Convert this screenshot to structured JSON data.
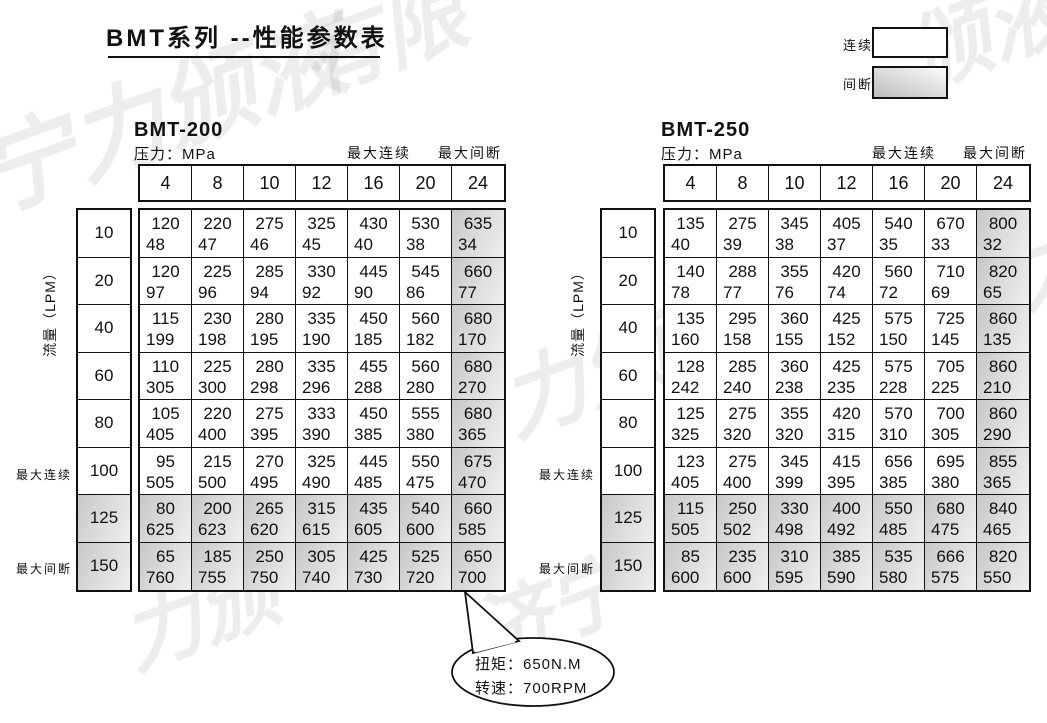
{
  "page": {
    "title": "BMT系列 --性能参数表",
    "watermark_text": "济宁力颁液压有限公司"
  },
  "legend": {
    "continuous": "连续",
    "intermittent": "间断"
  },
  "labels": {
    "pressure": "压力：MPa",
    "max_continuous": "最大连续",
    "max_intermittent": "最大间断",
    "flow_axis": "流量（LPM）"
  },
  "pressures_mpa": [
    "4",
    "8",
    "10",
    "12",
    "16",
    "20",
    "24"
  ],
  "flows_lpm": [
    "10",
    "20",
    "40",
    "60",
    "80",
    "100",
    "125",
    "150"
  ],
  "tables": [
    {
      "name": "BMT-200",
      "rows": [
        [
          [
            "120",
            "48"
          ],
          [
            "220",
            "47"
          ],
          [
            "275",
            "46"
          ],
          [
            "325",
            "45"
          ],
          [
            "430",
            "40"
          ],
          [
            "530",
            "38"
          ],
          [
            "635",
            "34"
          ]
        ],
        [
          [
            "120",
            "97"
          ],
          [
            "225",
            "96"
          ],
          [
            "285",
            "94"
          ],
          [
            "330",
            "92"
          ],
          [
            "445",
            "90"
          ],
          [
            "545",
            "86"
          ],
          [
            "660",
            "77"
          ]
        ],
        [
          [
            "115",
            "199"
          ],
          [
            "230",
            "198"
          ],
          [
            "280",
            "195"
          ],
          [
            "335",
            "190"
          ],
          [
            "450",
            "185"
          ],
          [
            "560",
            "182"
          ],
          [
            "680",
            "170"
          ]
        ],
        [
          [
            "110",
            "305"
          ],
          [
            "225",
            "300"
          ],
          [
            "280",
            "298"
          ],
          [
            "335",
            "296"
          ],
          [
            "455",
            "288"
          ],
          [
            "560",
            "280"
          ],
          [
            "680",
            "270"
          ]
        ],
        [
          [
            "105",
            "405"
          ],
          [
            "220",
            "400"
          ],
          [
            "275",
            "395"
          ],
          [
            "333",
            "390"
          ],
          [
            "450",
            "385"
          ],
          [
            "555",
            "380"
          ],
          [
            "680",
            "365"
          ]
        ],
        [
          [
            "95",
            "505"
          ],
          [
            "215",
            "500"
          ],
          [
            "270",
            "495"
          ],
          [
            "325",
            "490"
          ],
          [
            "445",
            "485"
          ],
          [
            "550",
            "475"
          ],
          [
            "675",
            "470"
          ]
        ],
        [
          [
            "80",
            "625"
          ],
          [
            "200",
            "623"
          ],
          [
            "265",
            "620"
          ],
          [
            "315",
            "615"
          ],
          [
            "435",
            "605"
          ],
          [
            "540",
            "600"
          ],
          [
            "660",
            "585"
          ]
        ],
        [
          [
            "65",
            "760"
          ],
          [
            "185",
            "755"
          ],
          [
            "250",
            "750"
          ],
          [
            "305",
            "740"
          ],
          [
            "425",
            "730"
          ],
          [
            "525",
            "720"
          ],
          [
            "650",
            "700"
          ]
        ]
      ]
    },
    {
      "name": "BMT-250",
      "rows": [
        [
          [
            "135",
            "40"
          ],
          [
            "275",
            "39"
          ],
          [
            "345",
            "38"
          ],
          [
            "405",
            "37"
          ],
          [
            "540",
            "35"
          ],
          [
            "670",
            "33"
          ],
          [
            "800",
            "32"
          ]
        ],
        [
          [
            "140",
            "78"
          ],
          [
            "288",
            "77"
          ],
          [
            "355",
            "76"
          ],
          [
            "420",
            "74"
          ],
          [
            "560",
            "72"
          ],
          [
            "710",
            "69"
          ],
          [
            "820",
            "65"
          ]
        ],
        [
          [
            "135",
            "160"
          ],
          [
            "295",
            "158"
          ],
          [
            "360",
            "155"
          ],
          [
            "425",
            "152"
          ],
          [
            "575",
            "150"
          ],
          [
            "725",
            "145"
          ],
          [
            "860",
            "135"
          ]
        ],
        [
          [
            "128",
            "242"
          ],
          [
            "285",
            "240"
          ],
          [
            "360",
            "238"
          ],
          [
            "425",
            "235"
          ],
          [
            "575",
            "228"
          ],
          [
            "705",
            "225"
          ],
          [
            "860",
            "210"
          ]
        ],
        [
          [
            "125",
            "325"
          ],
          [
            "275",
            "320"
          ],
          [
            "355",
            "320"
          ],
          [
            "420",
            "315"
          ],
          [
            "570",
            "310"
          ],
          [
            "700",
            "305"
          ],
          [
            "860",
            "290"
          ]
        ],
        [
          [
            "123",
            "405"
          ],
          [
            "275",
            "400"
          ],
          [
            "345",
            "399"
          ],
          [
            "415",
            "395"
          ],
          [
            "656",
            "385"
          ],
          [
            "695",
            "380"
          ],
          [
            "855",
            "365"
          ]
        ],
        [
          [
            "115",
            "505"
          ],
          [
            "250",
            "502"
          ],
          [
            "330",
            "498"
          ],
          [
            "400",
            "492"
          ],
          [
            "550",
            "485"
          ],
          [
            "680",
            "475"
          ],
          [
            "840",
            "465"
          ]
        ],
        [
          [
            "85",
            "600"
          ],
          [
            "235",
            "600"
          ],
          [
            "310",
            "595"
          ],
          [
            "385",
            "590"
          ],
          [
            "535",
            "580"
          ],
          [
            "666",
            "575"
          ],
          [
            "820",
            "550"
          ]
        ]
      ]
    }
  ],
  "callout": {
    "torque": "扭矩：650N.M",
    "speed": "转速：700RPM"
  },
  "watermarks": [
    "宁力颁液",
    "有限",
    "颁液",
    "济宁力颁",
    "力颁液压",
    "济宁",
    "力颁"
  ],
  "colors": {
    "shade_dark": "#c7c7c7",
    "shade_light": "#efefef",
    "border": "#111111"
  }
}
